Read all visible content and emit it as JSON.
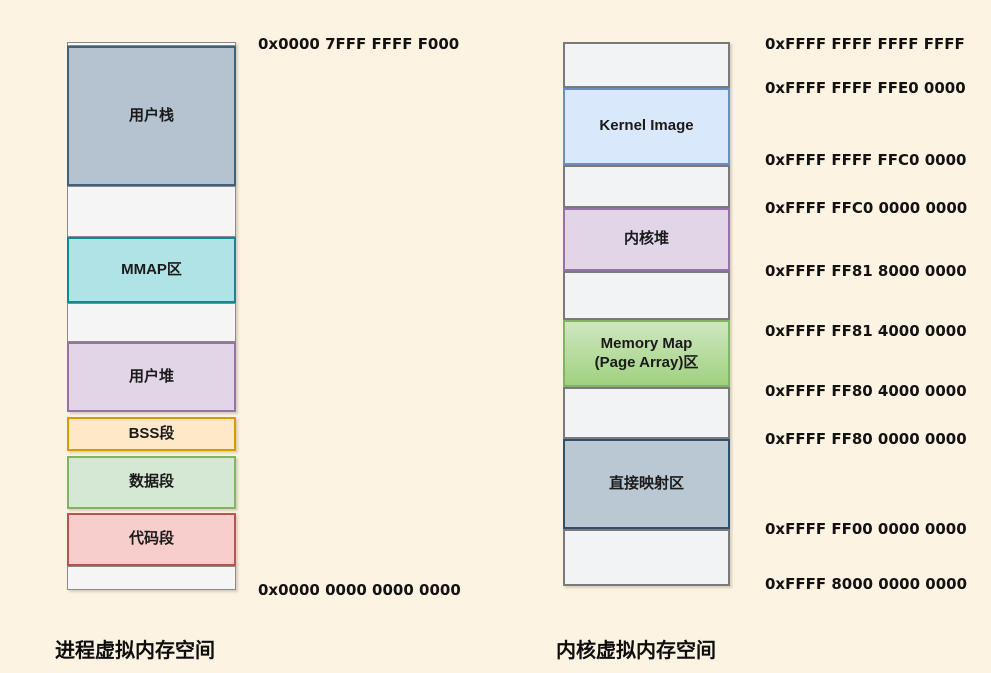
{
  "diagram": {
    "background": "#fdf3e2",
    "text_color": "#1a1a1a",
    "columns": [
      {
        "name": "process-virtual-memory",
        "caption": "进程虚拟内存空间",
        "x": 67,
        "width": 169,
        "address_x": 258,
        "segments": [
          {
            "name": "segment-top-strip",
            "label": "",
            "top": 42,
            "height": 4,
            "fill": "#fafafa",
            "border": "#8a8a8a",
            "bw": 1
          },
          {
            "name": "segment-user-stack",
            "label": "用户栈",
            "top": 46,
            "height": 140,
            "fill": "#b5c3d0",
            "border": "#41607c",
            "bw": 2
          },
          {
            "name": "segment-free-1",
            "label": "",
            "top": 186,
            "height": 51,
            "fill": "#f5f5f5",
            "border": "#8a8a8a",
            "bw": 1.5
          },
          {
            "name": "segment-mmap",
            "label": "MMAP区",
            "top": 237,
            "height": 66,
            "fill": "#b0e3e5",
            "border": "#12888e",
            "bw": 2
          },
          {
            "name": "segment-free-2",
            "label": "",
            "top": 303,
            "height": 39,
            "fill": "#f5f5f5",
            "border": "#8a8a8a",
            "bw": 1.5
          },
          {
            "name": "segment-user-heap",
            "label": "用户堆",
            "top": 342,
            "height": 70,
            "fill": "#e1d5e7",
            "border": "#9673a6",
            "bw": 2
          },
          {
            "name": "segment-bss",
            "label": "BSS段",
            "top": 417,
            "height": 34,
            "fill": "#ffe8c8",
            "border": "#d79b00",
            "bw": 2
          },
          {
            "name": "segment-data",
            "label": "数据段",
            "top": 456,
            "height": 53,
            "fill": "#d5e8d4",
            "border": "#82b366",
            "bw": 2
          },
          {
            "name": "segment-code",
            "label": "代码段",
            "top": 513,
            "height": 53,
            "fill": "#f8cecc",
            "border": "#b85450",
            "bw": 2
          },
          {
            "name": "segment-free-3",
            "label": "",
            "top": 566,
            "height": 24,
            "fill": "#f5f5f5",
            "border": "#8a8a8a",
            "bw": 1.5
          }
        ],
        "addresses": [
          {
            "text": "0x0000 7FFF FFFF F000",
            "y": 44
          },
          {
            "text": "0x0000 0000 0000 0000",
            "y": 590
          }
        ]
      },
      {
        "name": "kernel-virtual-memory",
        "caption": "内核虚拟内存空间",
        "x": 563,
        "width": 167,
        "address_x": 765,
        "segments": [
          {
            "name": "segment-free-top",
            "label": "",
            "top": 42,
            "height": 46,
            "fill": "#f2f3f4",
            "border": "#7a7a7a",
            "bw": 2
          },
          {
            "name": "segment-kernel-image",
            "label": "Kernel Image",
            "top": 88,
            "height": 77,
            "fill": "#dae8fc",
            "border": "#6c8ebf",
            "bw": 2
          },
          {
            "name": "segment-free-4",
            "label": "",
            "top": 165,
            "height": 43,
            "fill": "#f2f3f4",
            "border": "#7a7a7a",
            "bw": 2
          },
          {
            "name": "segment-kernel-heap",
            "label": "内核堆",
            "top": 208,
            "height": 63,
            "fill": "#e1d5e7",
            "border": "#9673a6",
            "bw": 2
          },
          {
            "name": "segment-free-5",
            "label": "",
            "top": 271,
            "height": 49,
            "fill": "#f2f3f4",
            "border": "#7a7a7a",
            "bw": 2
          },
          {
            "name": "segment-memory-map",
            "label": "Memory Map\n(Page Array)区",
            "top": 320,
            "height": 67,
            "fill": "#cfe7c0",
            "fill2": "#a0d180",
            "border": "#82b366",
            "bw": 2
          },
          {
            "name": "segment-free-6",
            "label": "",
            "top": 387,
            "height": 52,
            "fill": "#f2f3f4",
            "border": "#7a7a7a",
            "bw": 2
          },
          {
            "name": "segment-direct-mapping",
            "label": "直接映射区",
            "top": 439,
            "height": 90,
            "fill": "#b9c8d3",
            "border": "#33506b",
            "bw": 2
          },
          {
            "name": "segment-free-7",
            "label": "",
            "top": 529,
            "height": 57,
            "fill": "#f2f3f4",
            "border": "#7a7a7a",
            "bw": 2
          }
        ],
        "addresses": [
          {
            "text": "0xFFFF FFFF FFFF FFFF",
            "y": 44
          },
          {
            "text": "0xFFFF FFFF FFE0 0000",
            "y": 88
          },
          {
            "text": "0xFFFF FFFF FFC0 0000",
            "y": 160
          },
          {
            "text": "0xFFFF FFC0 0000 0000",
            "y": 208
          },
          {
            "text": "0xFFFF FF81 8000 0000",
            "y": 271
          },
          {
            "text": "0xFFFF FF81 4000 0000",
            "y": 331
          },
          {
            "text": "0xFFFF FF80 4000 0000",
            "y": 391
          },
          {
            "text": "0xFFFF FF80 0000 0000",
            "y": 439
          },
          {
            "text": "0xFFFF FF00 0000 0000",
            "y": 529
          },
          {
            "text": "0xFFFF 8000 0000 0000",
            "y": 584
          }
        ]
      }
    ]
  }
}
